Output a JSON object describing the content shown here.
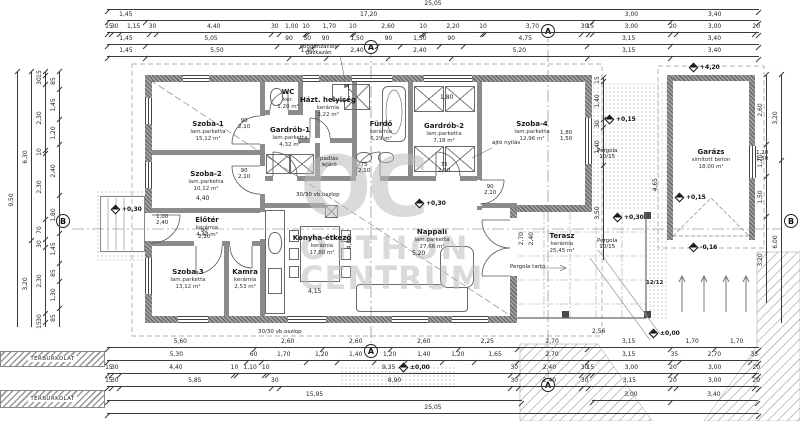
{
  "wm": {
    "logo": "OC",
    "l1": "OTTHON",
    "l2": "CENTRUM"
  },
  "rooms": {
    "szoba1": {
      "name": "Szoba-1",
      "floor": "lam.parketta",
      "area": "15,12 m²"
    },
    "szoba2": {
      "name": "Szoba-2",
      "floor": "lam.parketta",
      "area": "10,12 m²"
    },
    "szoba3": {
      "name": "Szoba-3",
      "floor": "lam.parketta",
      "area": "13,12 m²"
    },
    "szoba4": {
      "name": "Szoba-4",
      "floor": "lam.parketta",
      "area": "12,96 m²"
    },
    "wc": {
      "name": "WC",
      "floor": "ker.",
      "area": "1,20 m²"
    },
    "hazt": {
      "name": "Házt. helyiség",
      "floor": "kerámia",
      "area": "3,22 m²"
    },
    "gardrob1": {
      "name": "Gardrób-1",
      "floor": "lam.parketta",
      "area": "4,32 m²"
    },
    "furdo": {
      "name": "Fürdő",
      "floor": "kerámia",
      "area": "6,29 m²"
    },
    "gardrob2": {
      "name": "Gardrób-2",
      "floor": "lam.parketta",
      "area": "7,18 m²"
    },
    "eloter": {
      "name": "Előtér",
      "floor": "kerámia",
      "area": "4,48 m²"
    },
    "kamra": {
      "name": "Kamra",
      "floor": "kerámia",
      "area": "2,53 m²"
    },
    "konyha": {
      "name": "Konyha-étkező",
      "floor": "kerámia",
      "area": "17,80 m²"
    },
    "nappali": {
      "name": "Nappali",
      "floor": "lam.parketta",
      "area": "27,66 m²"
    },
    "terasz": {
      "name": "Terasz",
      "floor": "kerámia",
      "area": "25,45 m²"
    },
    "garazs": {
      "name": "Garázs",
      "floor": "simított beton",
      "area": "18,00 m²"
    }
  },
  "dims": {
    "t1": [
      "25,05"
    ],
    "t2": [
      "1,45",
      "17,20",
      "3,00",
      "3,40"
    ],
    "t3": [
      "15",
      "30",
      "1,15",
      "30",
      "4,40",
      "30",
      "1,00",
      "10",
      "1,70",
      "10",
      "2,60",
      "10",
      "2,20",
      "10",
      "3,70",
      "30",
      "15",
      "3,00",
      "20",
      "3,00",
      "20"
    ],
    "t4": [
      "1,45",
      "5,05",
      "90",
      "50",
      "90",
      "1,50",
      "90",
      "1,50",
      "90",
      "4,75",
      "3,15",
      "3,40"
    ],
    "t5": [
      "1,45",
      "5,50",
      "1,40",
      "2,40",
      "2,40",
      "5,20",
      "3,15",
      "3,40"
    ],
    "b1": [
      "5,60",
      "2,60",
      "2,60",
      "2,60",
      "2,25",
      "2,70",
      "3,15",
      "1,70",
      "1,70"
    ],
    "b2": [
      "5,30",
      "60",
      "1,70",
      "1,20",
      "1,40",
      "1,20",
      "1,40",
      "1,20",
      "1,65",
      "2,70",
      "3,15",
      "35",
      "2,70",
      "35"
    ],
    "b3": [
      "15",
      "30",
      "4,40",
      "10",
      "1,10",
      "10",
      "9,35",
      "30",
      "2,40",
      "30",
      "15",
      "3,00",
      "20",
      "3,00",
      "20"
    ],
    "b4": [
      "15",
      "30",
      "5,85",
      "30",
      "8,90",
      "30",
      "2,40",
      "30",
      "3,15",
      "20",
      "3,00",
      "20"
    ],
    "b5": [
      "15,95"
    ],
    "b5b": [
      "3,00",
      "3,40"
    ],
    "b6": [
      "25,05"
    ],
    "l1": [
      "9,50"
    ],
    "l2": [
      "6,30",
      "3,20"
    ],
    "l3": [
      "15",
      "30",
      "2,30",
      "10",
      "2,30",
      "70",
      "30",
      "2,30",
      "30",
      "15"
    ],
    "l4": [
      "85",
      "1,45",
      "1,20",
      "2,40",
      "1,80",
      "1,45",
      "85",
      "1,30",
      "85"
    ],
    "r1": [
      "2,60",
      "1,20",
      "1,50",
      "3,20"
    ],
    "r2": [
      "3,20",
      "6,00"
    ],
    "rm": [
      "15",
      "1,40",
      "30",
      "1,40",
      "3,50"
    ]
  },
  "openings": [
    {
      "w": "90",
      "h": "2,10"
    },
    {
      "w": "90",
      "h": "2,10"
    },
    {
      "w": "90",
      "h": "2,10"
    },
    {
      "w": "75",
      "h": "2,10"
    },
    {
      "w": "75",
      "h": "2,10"
    },
    {
      "w": "90",
      "h": "2,10"
    },
    {
      "w": "1,00",
      "h": "2,40"
    },
    {
      "w": "1,80",
      "h": "1,50"
    },
    {
      "w": "1,20",
      "h": "1,50"
    }
  ],
  "inner": [
    "4,40",
    "5,20",
    "4,15",
    "4,80",
    "2,70",
    "2,40",
    "2,56",
    "4,65",
    "1,80"
  ],
  "levels": {
    "a": "+0,30",
    "b": "+0,30",
    "c": "+0,30",
    "d": "+0,15",
    "e": "+0,15",
    "f": "±0,00",
    "g": "±0,00",
    "h": "-0,16",
    "i": "+4,20"
  },
  "callouts": {
    "boiler1": "kondenzációs",
    "boiler2": "gázkazán",
    "attic1": "padlás",
    "attic2": "lejáró",
    "door": "ajtó nyílás",
    "col1": "30/30",
    "col2": "vb.oszlop",
    "colb1": "30/30",
    "colb2": "vb.oszlop",
    "perg1": "Pergola",
    "perg2": "10/15",
    "pergb1": "Pergola",
    "pergb2": "10/15",
    "beam": "Pergola tartó",
    "beamsize": "12/12",
    "paving": "TÉRBURKOLAT",
    "m": "M"
  },
  "markers": {
    "a": "A",
    "b": "B"
  }
}
